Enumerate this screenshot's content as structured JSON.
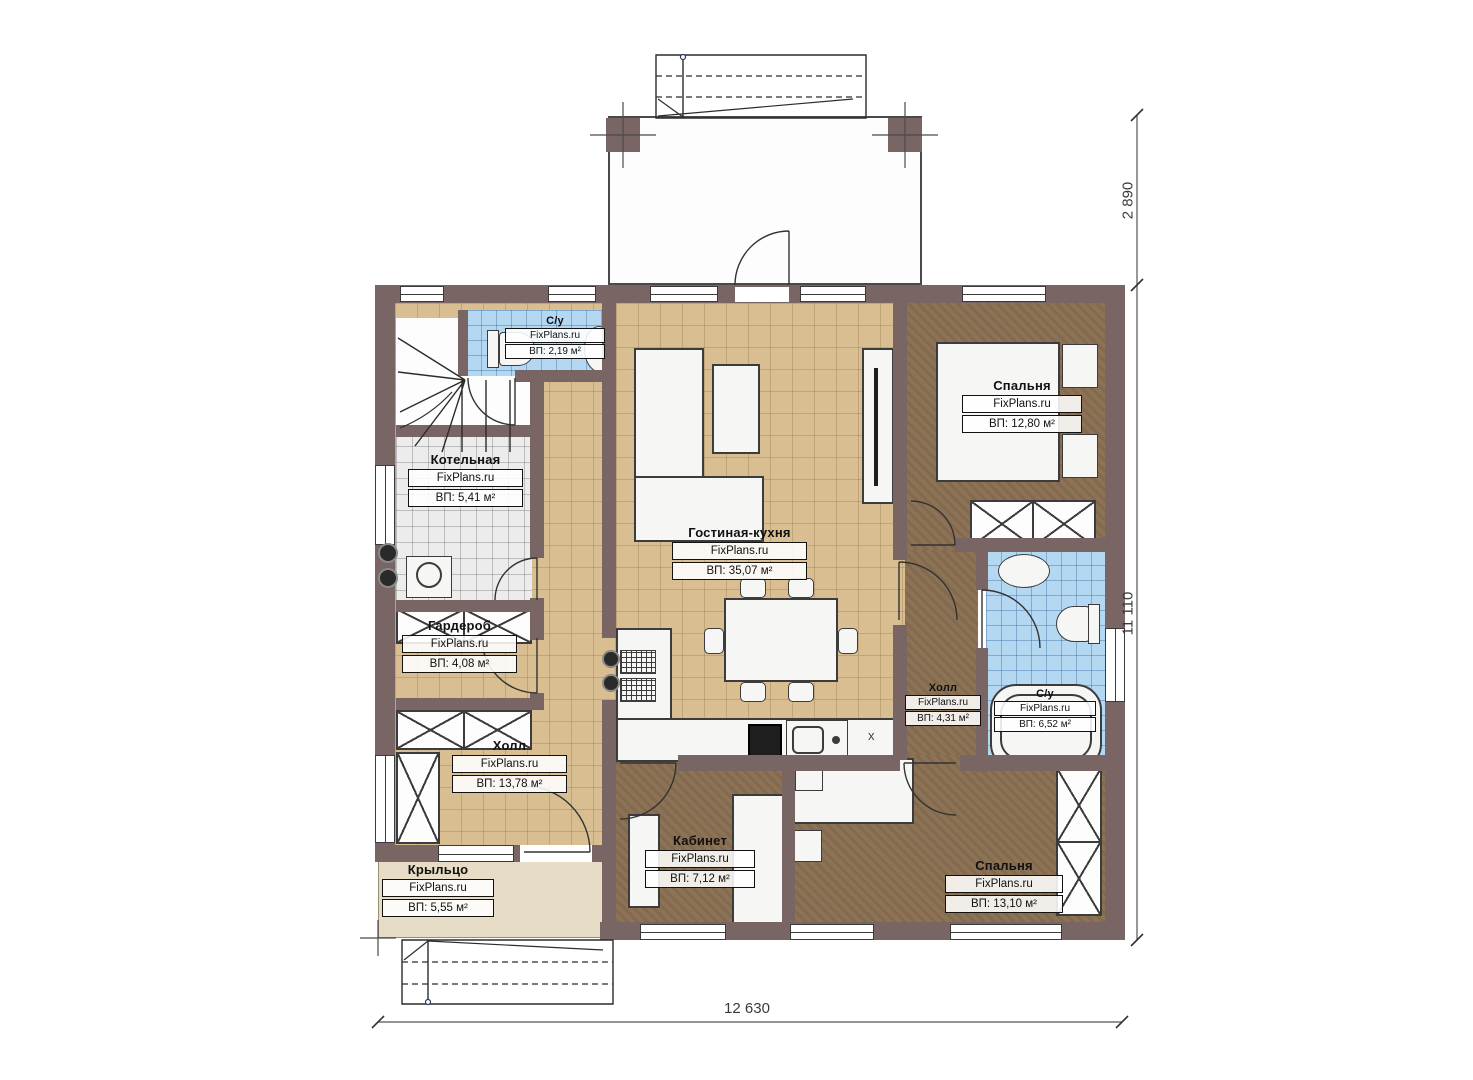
{
  "plan": {
    "brand": "FixPlans.ru",
    "rooms": [
      {
        "name": "С/у",
        "area": "ВП: 2,19 м²"
      },
      {
        "name": "Котельная",
        "area": "ВП: 5,41 м²"
      },
      {
        "name": "Гардероб",
        "area": "ВП: 4,08 м²"
      },
      {
        "name": "Холл",
        "area": "ВП: 13,78 м²"
      },
      {
        "name": "Крыльцо",
        "area": "ВП: 5,55 м²"
      },
      {
        "name": "Гостиная-кухня",
        "area": "ВП: 35,07 м²"
      },
      {
        "name": "Спальня",
        "area": "ВП: 12,80 м²"
      },
      {
        "name": "Холл",
        "area": "ВП: 4,31 м²"
      },
      {
        "name": "С/у",
        "area": "ВП: 6,52 м²"
      },
      {
        "name": "Кабинет",
        "area": "ВП: 7,12 м²"
      },
      {
        "name": "Спальня",
        "area": "ВП: 13,10 м²"
      }
    ],
    "dimensions": {
      "terrace_depth": "2 890",
      "house_depth": "11 110",
      "house_width": "12 630"
    },
    "kitchen_marker": "x",
    "colors": {
      "wall": "#7a6565",
      "tile_beige": "#d8be90",
      "tile_blue": "#b5d8f2",
      "tile_gray": "#ececec",
      "floor_brown": "#8d7355",
      "porch": "#e7dcc6"
    }
  }
}
